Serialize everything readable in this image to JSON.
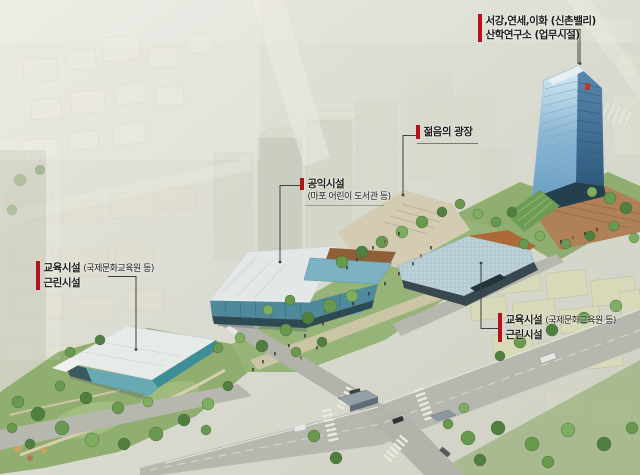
{
  "labels": {
    "research": {
      "line1": "서강,연세,이화 (신촌밸리)",
      "line2": "산학연구소 (업무시설)"
    },
    "plaza": {
      "line1": "젊음의 광장"
    },
    "public_facility": {
      "line1": "공익시설",
      "line2": "(마포 어린이 도서관 등)"
    },
    "education_left": {
      "title": "교육시설",
      "subtitle": "(국제문화교육원 등)",
      "line2": "근린시설"
    },
    "education_right": {
      "title": "교육시설",
      "subtitle": "(국제문화교육원 등)",
      "line2": "근린시설"
    }
  },
  "colors": {
    "label_marker_red": "#b5121b",
    "label_text": "#1b1b1b",
    "leader_line": "#3f3f3f",
    "background": "#dcddd3",
    "park_green": "#97b478",
    "road_gray": "#b6b7af",
    "plaza_paving": "#b08057",
    "tower_glass_light": "#9cc4dd",
    "tower_glass_dark": "#3d6d92",
    "building_glass": "#5d9aaa",
    "orange_roof": "#ad6a38"
  }
}
